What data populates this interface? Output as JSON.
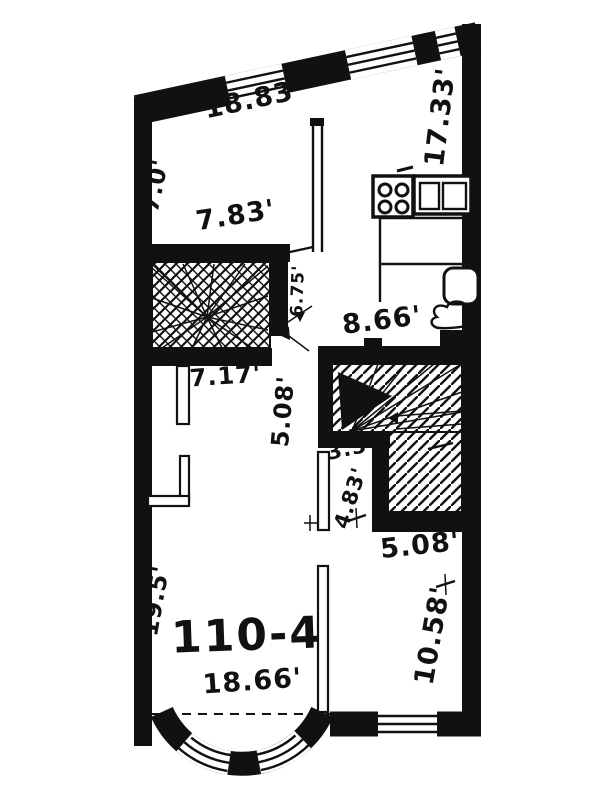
{
  "colors": {
    "ink": "#111111",
    "paper": "#ffffff"
  },
  "unit": {
    "number": "110-4"
  },
  "dimensions": {
    "top_wall": "18.83'",
    "right_wall_upper": "17.33'",
    "left_wall_upper": "7.0'",
    "bedroom_width": "7.83'",
    "stair_opening": "6.75'",
    "kitchen_width": "8.66'",
    "hall_width": "7.17'",
    "hall_length": "5.08'",
    "entry_width": "3.5'",
    "entry_length": "4.83'",
    "right_room_upper_width": "5.08'",
    "living_room_length": "19.5'",
    "living_room_width": "18.66'",
    "right_room_length": "10.58'"
  }
}
